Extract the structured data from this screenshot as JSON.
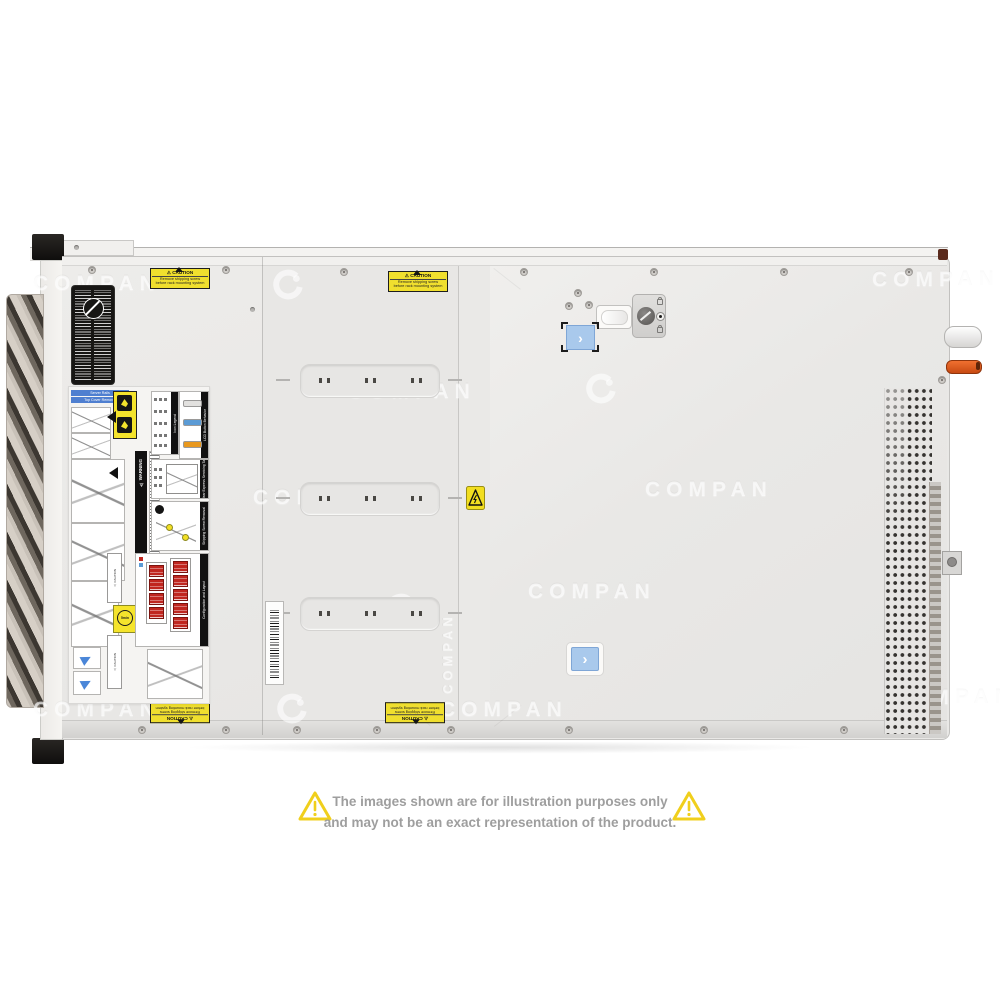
{
  "disclaimer": {
    "line1": "The images shown are for illustration purposes only",
    "line2": "and may not be an exact representation of the product."
  },
  "watermark": {
    "text": "COMPAN"
  },
  "stickers": {
    "caution_small": {
      "title": "⚠ CAUTION",
      "line1": "Remove shipping screw",
      "line2": "before rack mounting system"
    },
    "rails": {
      "bar1": "Server Rails",
      "bar2": "Top Cover Removal"
    },
    "warning_strip": {
      "title": "⚠ WARNING"
    },
    "caution_strip": {
      "title": "⚠ CAUTION"
    },
    "icon_legend": {
      "title": "Icon Legend"
    },
    "lcd": {
      "title": "LCD Button Behavior"
    },
    "rear_tag": {
      "title": "Rear Express Servicing Tag"
    },
    "shipping": {
      "title": "Shipping Screw Removal"
    },
    "config": {
      "title": "Configuration and Layout"
    },
    "wait": {
      "text": "5min"
    }
  },
  "colors": {
    "caution_yellow": "#f0df2e",
    "latch_blue": "#a9c9ec",
    "lcd_blue": "#5b9bd5",
    "lcd_orange": "#e8981e",
    "handle_orange": "#e05a1e",
    "config_red": "#c0261f",
    "rails_blue": "#4f7fd0",
    "disclaimer_triangle_yellow": "#f0cf1c",
    "disclaimer_text_gray": "#9e9e9e"
  }
}
